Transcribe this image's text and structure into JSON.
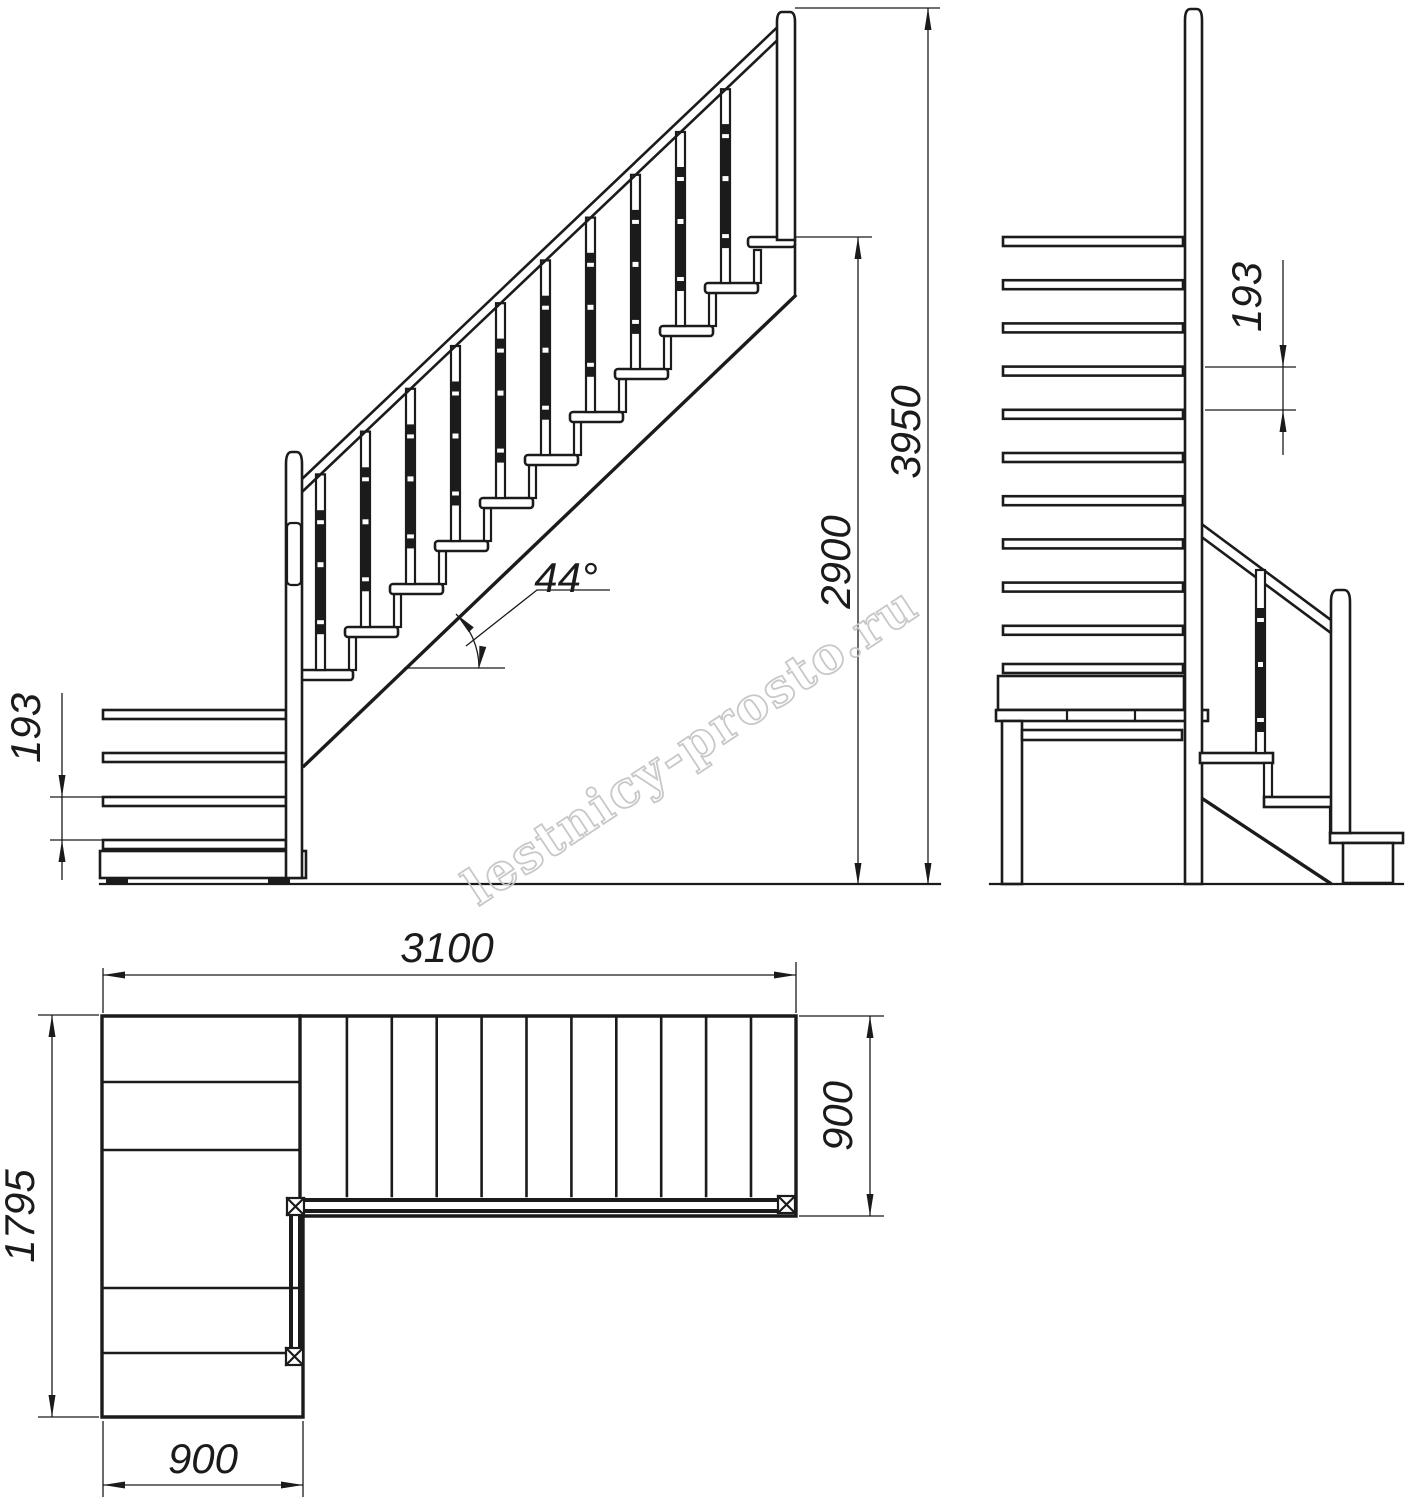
{
  "drawing": {
    "title": "L-shaped quarter-turn staircase technical drawing, three orthographic views",
    "watermark": "lestnicy-prosto.ru",
    "line_color": "#1b1b1b",
    "watermark_color": "#c6c6c6",
    "background_color": "#ffffff"
  },
  "dims": {
    "side_overall_height": "3950",
    "side_floor_to_top_tread": "2900",
    "side_riser_height": "193",
    "side_incline_angle": "44°",
    "front_riser_height": "193",
    "plan_overall_length": "3100",
    "plan_upper_flight_width": "900",
    "plan_overall_depth": "1795",
    "plan_lower_flight_width": "900"
  }
}
